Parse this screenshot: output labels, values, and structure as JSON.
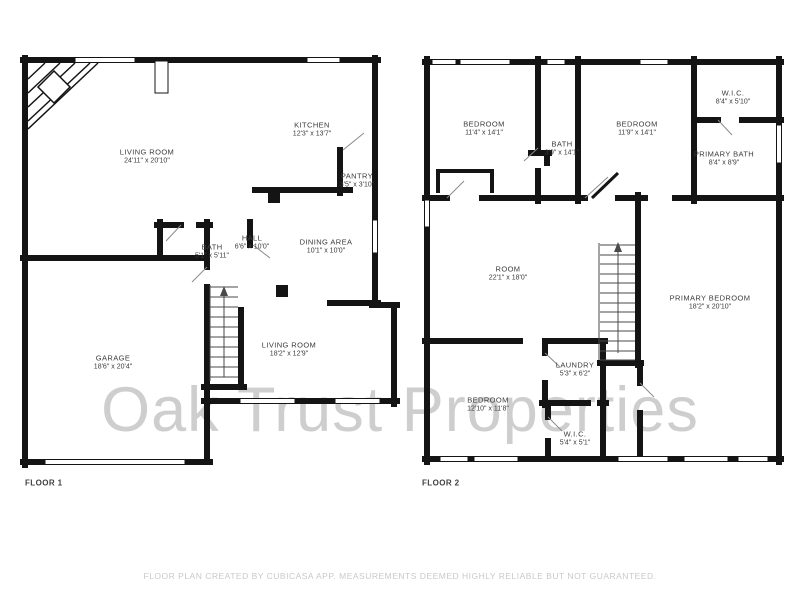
{
  "watermark": "Oak Trust Properties",
  "disclaimer": "FLOOR PLAN CREATED BY CUBICASA APP. MEASUREMENTS DEEMED HIGHLY RELIABLE BUT NOT GUARANTEED.",
  "colors": {
    "wall": "#141414",
    "room_label": "#3b3b3b",
    "watermark": "#9e9e9e",
    "disclaimer": "#c9c9c9",
    "background": "#ffffff"
  },
  "floors": [
    {
      "label": "FLOOR 1",
      "label_pos": {
        "x": 25,
        "y": 483
      },
      "rooms": [
        {
          "name": "LIVING ROOM",
          "dims": "24'11\" x 20'10\"",
          "x": 147,
          "y": 156
        },
        {
          "name": "KITCHEN",
          "dims": "12'3\" x 13'7\"",
          "x": 312,
          "y": 129
        },
        {
          "name": "PANTRY",
          "dims": "3'5\" x 3'10\"",
          "x": 357,
          "y": 180
        },
        {
          "name": "BATH",
          "dims": "5'1\" x 5'11\"",
          "x": 212,
          "y": 251
        },
        {
          "name": "HALL",
          "dims": "6'6\" x 10'0\"",
          "x": 252,
          "y": 242
        },
        {
          "name": "DINING AREA",
          "dims": "10'1\" x 10'0\"",
          "x": 326,
          "y": 246
        },
        {
          "name": "GARAGE",
          "dims": "18'6\" x 20'4\"",
          "x": 113,
          "y": 362
        },
        {
          "name": "LIVING ROOM",
          "dims": "18'2\" x 12'9\"",
          "x": 289,
          "y": 349
        }
      ]
    },
    {
      "label": "FLOOR 2",
      "label_pos": {
        "x": 422,
        "y": 483
      },
      "rooms": [
        {
          "name": "BEDROOM",
          "dims": "11'4\" x 14'1\"",
          "x": 484,
          "y": 128
        },
        {
          "name": "BATH",
          "dims": "3'9\" x 14'1\"",
          "x": 562,
          "y": 148
        },
        {
          "name": "BEDROOM",
          "dims": "11'9\" x 14'1\"",
          "x": 637,
          "y": 128
        },
        {
          "name": "W.I.C.",
          "dims": "8'4\" x 5'10\"",
          "x": 733,
          "y": 97
        },
        {
          "name": "PRIMARY BATH",
          "dims": "8'4\" x 8'9\"",
          "x": 724,
          "y": 158
        },
        {
          "name": "ROOM",
          "dims": "22'1\" x 18'0\"",
          "x": 508,
          "y": 273
        },
        {
          "name": "PRIMARY BEDROOM",
          "dims": "18'2\" x 20'10\"",
          "x": 710,
          "y": 302
        },
        {
          "name": "LAUNDRY",
          "dims": "5'3\" x 6'2\"",
          "x": 575,
          "y": 369
        },
        {
          "name": "BEDROOM",
          "dims": "12'10\" x 11'8\"",
          "x": 488,
          "y": 404
        },
        {
          "name": "W.I.C.",
          "dims": "5'4\" x 5'1\"",
          "x": 575,
          "y": 438
        }
      ]
    }
  ]
}
